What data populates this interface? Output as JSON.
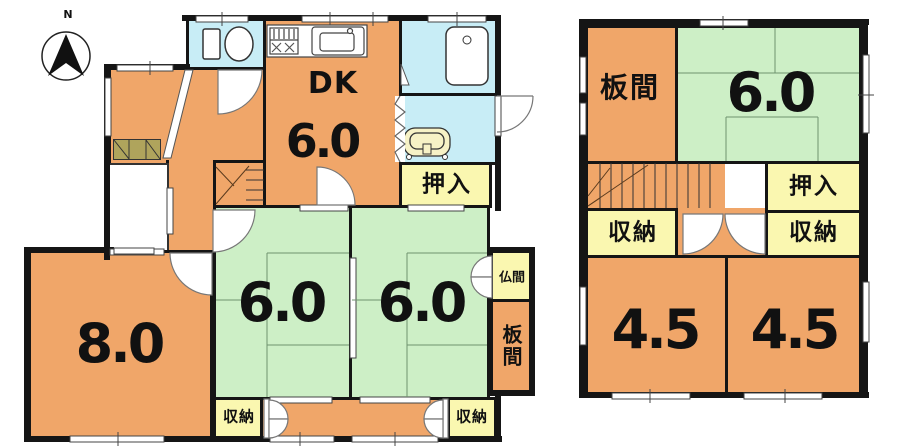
{
  "compass": {
    "label": "N"
  },
  "palette": {
    "wall": "#151515",
    "room_orange": "#F0A669",
    "tatami_green": "#CDEFC6",
    "water_blue": "#C8EDF6",
    "closet_yellow": "#FAF7B0",
    "cabinet_khaki": "#AFA45C"
  },
  "floor1": {
    "dk": {
      "label": "DK",
      "area": "6.0"
    },
    "oshiire": {
      "label": "押入"
    },
    "room8": {
      "area": "8.0"
    },
    "tatami_center": {
      "area": "6.0"
    },
    "tatami_east": {
      "area": "6.0"
    },
    "butsuma": {
      "label": "仏間"
    },
    "itanoma": {
      "label": "板間"
    },
    "storage_sw": {
      "label": "収納"
    },
    "storage_se": {
      "label": "収納"
    }
  },
  "floor2": {
    "itanoma": {
      "label": "板間"
    },
    "tatami": {
      "area": "6.0"
    },
    "oshiire": {
      "label": "押入"
    },
    "storage_w": {
      "label": "収納"
    },
    "storage_e": {
      "label": "収納"
    },
    "room_sw": {
      "area": "4.5"
    },
    "room_se": {
      "area": "4.5"
    }
  }
}
